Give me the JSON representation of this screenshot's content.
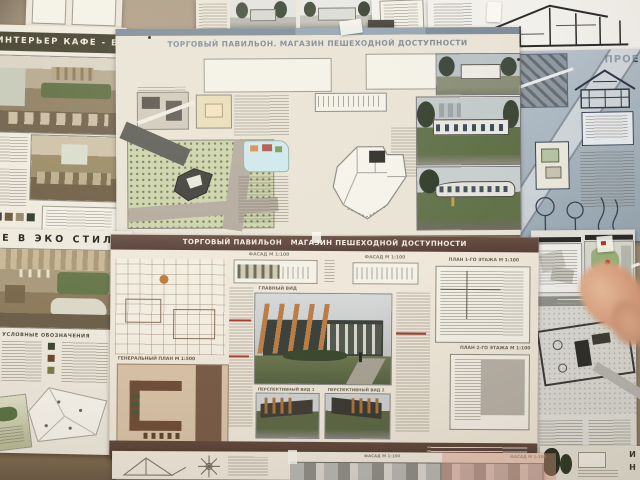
{
  "scene": {
    "type": "photograph of architectural student presentation posters pinned to a wall",
    "language": "Russian",
    "colors": {
      "wall": "#a8977f",
      "paper": "#ece6d8",
      "cafe_title_bar": "#43402f",
      "mid_poster_bar": "#5d463b",
      "blueprint": "#a9b6c1",
      "site_green": "#cdd3ac",
      "plan_brown": "#74523c",
      "fin_orange": "#b97f48",
      "marker_red": "#c13220",
      "finger_skin": "#e2ac8d"
    }
  },
  "posters": {
    "cafe": {
      "title": "ИНТЕРЬЕР КАФЕ - БАРА"
    },
    "pavilion_top": {
      "title": "ТОРГОВЫЙ ПАВИЛЬОН. МАГАЗИН ПЕШЕХОДНОЙ ДОСТУПНОСТИ"
    },
    "blueprint": {
      "title": "ПРОЕК"
    },
    "eco": {
      "title": "Е В ЭКО СТИЛЕ",
      "vertical_label": "БАМБОО",
      "legend_title": "УСЛОВНЫЕ ОБОЗНАЧЕНИЯ"
    },
    "pavilion_mid": {
      "title": "ТОРГОВЫЙ ПАВИЛЬОН   МАГАЗИН ПЕШЕХОДНОЙ ДОСТУПНОСТИ",
      "captions": {
        "facade": "ФАСАД М 1:100",
        "general_plan": "ГЕНЕРАЛЬНЫЙ ПЛАН М 1:500",
        "main_view": "ГЛАВНЫЙ ВИД",
        "perspective_1": "ПЕРСПЕКТИВНЫЙ ВИД 1",
        "perspective_2": "ПЕРСПЕКТИВНЫЙ ВИД 2",
        "plan_floor_1": "ПЛАН 1-ГО ЭТАЖА М 1:100",
        "plan_floor_2": "ПЛАН 2-ГО ЭТАЖА М 1:100"
      }
    },
    "bottom_fragment": {
      "facade_caption": "ФАСАД М 1:100",
      "edge_letters": "ИН"
    }
  }
}
